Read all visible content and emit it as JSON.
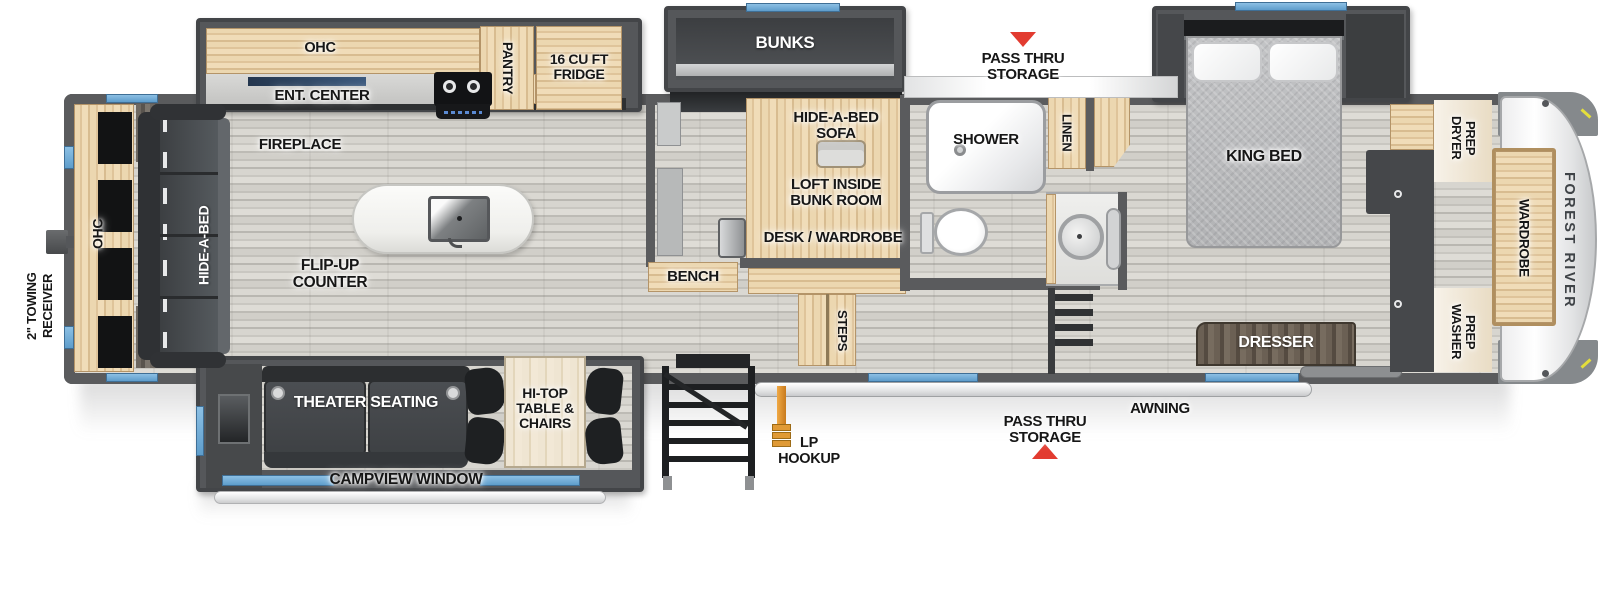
{
  "floorplan": {
    "brand": "FOREST RIVER",
    "exterior": {
      "towing_receiver": "2\" TOWING RECEIVER",
      "pass_thru": "PASS THRU STORAGE",
      "awning": "AWNING",
      "lp_hookup": "LP HOOKUP"
    },
    "living": {
      "ohc_rear": "OHC",
      "hide_a_bed": "HIDE-A-BED",
      "fireplace": "FIREPLACE",
      "flip_up_counter": "FLIP-UP COUNTER",
      "theater_seating": "THEATER SEATING",
      "hi_top_table": "HI-TOP TABLE & CHAIRS",
      "campview_window": "CAMPVIEW WINDOW"
    },
    "kitchen": {
      "ohc": "OHC",
      "ent_center": "ENT. CENTER",
      "pantry": "PANTRY",
      "fridge": "16 CU FT FRIDGE"
    },
    "bunk_room": {
      "bunks": "BUNKS",
      "hide_a_bed_sofa": "HIDE-A-BED SOFA",
      "loft": "LOFT INSIDE BUNK ROOM",
      "desk_wardrobe": "DESK / WARDROBE",
      "bench": "BENCH",
      "steps": "STEPS"
    },
    "bathroom": {
      "shower": "SHOWER",
      "linen": "LINEN"
    },
    "bedroom": {
      "king_bed": "KING BED",
      "dresser": "DRESSER",
      "wardrobe": "WARDROBE",
      "dryer_prep": "DRYER PREP",
      "washer_prep": "WASHER PREP"
    },
    "colors": {
      "wall": "#5a5b5d",
      "wood": "#e3cba3",
      "window_blue": "#6fa8d4",
      "arrow_red": "#e23b30",
      "lp_orange": "#dd8a2e"
    }
  }
}
